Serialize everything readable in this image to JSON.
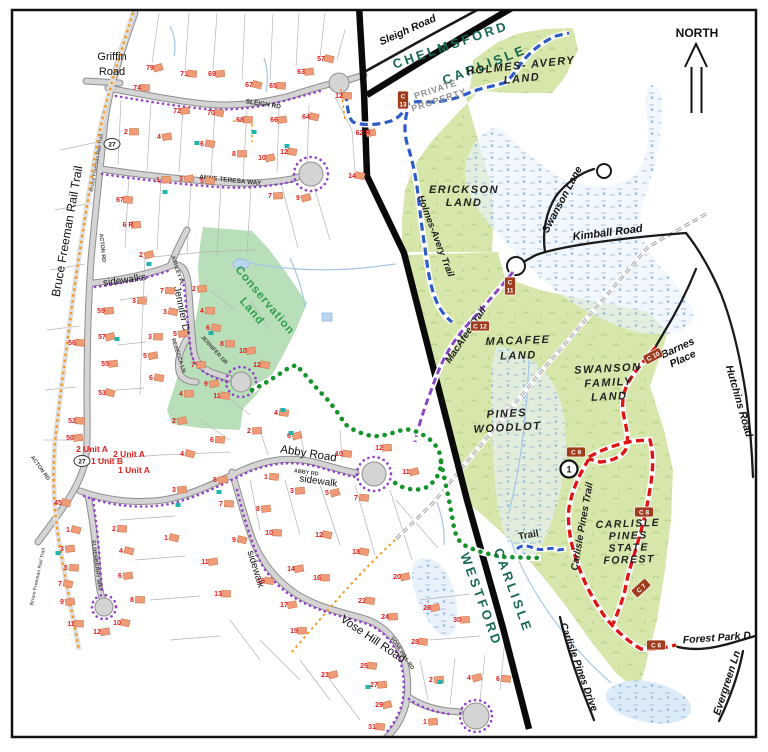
{
  "map": {
    "north_label": "NORTH",
    "towns": {
      "chelmsford": "CHELMSFORD",
      "carlisle_top": "CARLISLE",
      "westford": "WESTFORD",
      "carlisle_bottom": "CARLISLE"
    },
    "lands": {
      "holmes_avery": [
        "HOLMES- AVERY",
        "LAND"
      ],
      "erickson": [
        "ERICKSON",
        "LAND"
      ],
      "macafee": [
        "MACAFEE",
        "LAND"
      ],
      "swanson_family": [
        "SWANSON",
        "FAMILY",
        "LAND"
      ],
      "pines_woodlot": [
        "PINES",
        "WOODLOT"
      ],
      "carlisle_pines_forest": [
        "CARLISLE",
        "PINES",
        "STATE",
        "FOREST"
      ],
      "conservation": [
        "Conservation",
        "Land"
      ]
    },
    "trails": {
      "holmes_avery_trail": {
        "label": "Holmes-Avery Trail",
        "color": "#2d5bc8"
      },
      "macafee_trail": {
        "label": "MacAfee Trail",
        "color": "#8a49c0"
      },
      "carlisle_pines_trail": {
        "label": "Carlisle Pines Trail",
        "color": "#e01414"
      },
      "trail": {
        "label": "Trail",
        "color": "#2d5bc8"
      },
      "connector_dots_color": "#14932b",
      "sidewalk_dots_color": "#9440cc",
      "rail_trail_color": "#f5991e"
    },
    "roads": {
      "griffin": [
        "Griffin",
        "Road"
      ],
      "sleigh_small": "SLEIGH RD",
      "sleigh_road": "Sleigh Road",
      "acton": "ACTON RD",
      "anne_teresa": "ANNE TERESA WAY",
      "ashley": "ASHLEY PL",
      "jennifer": "Jennifer Dr",
      "jennifer_small": "JENNIFER DR",
      "rebecca": "REBECCA LN",
      "abby": "Abby Road",
      "abby_small": "ABBY RD",
      "vose": "Vose Hill Road",
      "vose_small": "VOSE HILL RD",
      "elderberry": "ELDERBERRY WAY",
      "bruce_freeman": "Bruce Freeman Rail Trail",
      "bruce_freeman_small": "Bruce Freeman Rail Trail",
      "swanson_lane": "Swanson Lane",
      "kimball": "Kimball Road",
      "hutchins": "Hutchins Road",
      "barnes": [
        "Barnes",
        "Place"
      ],
      "forest_park": "Forest Park D",
      "evergreen": "Evergreen Ln",
      "carlisle_pines_drive": "Carlisle Pines Drive"
    },
    "labels": {
      "private_property": [
        "PRIVATE",
        "PROPERTY"
      ],
      "sidewalks": "sidewalks",
      "sidewalk": "sidewalk",
      "route_shield": "27"
    },
    "unit_labels": [
      {
        "text": "2 Unit A",
        "x": 92,
        "y": 452
      },
      {
        "text": "2 Unit A",
        "x": 129,
        "y": 457
      },
      {
        "text": "1 Unit B",
        "x": 107,
        "y": 464
      },
      {
        "text": "1 Unit A",
        "x": 134,
        "y": 473
      }
    ],
    "markers": [
      {
        "id": "C13",
        "c": "C",
        "n": "13",
        "x": 403,
        "y": 100,
        "vert": true,
        "rot": 0
      },
      {
        "id": "C11",
        "c": "C",
        "n": "11",
        "x": 510,
        "y": 286,
        "vert": true,
        "rot": 0
      },
      {
        "id": "C12",
        "c": "C",
        "n": "12",
        "x": 480,
        "y": 326,
        "vert": false,
        "rot": 0
      },
      {
        "id": "C10",
        "c": "C",
        "n": "10",
        "x": 653,
        "y": 356,
        "vert": false,
        "rot": -28
      },
      {
        "id": "C9",
        "c": "C",
        "n": "9",
        "x": 576,
        "y": 452,
        "vert": false,
        "rot": 0
      },
      {
        "id": "C8",
        "c": "C",
        "n": "8",
        "x": 644,
        "y": 512,
        "vert": false,
        "rot": 0
      },
      {
        "id": "C7",
        "c": "C",
        "n": "7",
        "x": 641,
        "y": 588,
        "vert": false,
        "rot": -42
      },
      {
        "id": "C6",
        "c": "C",
        "n": "6",
        "x": 656,
        "y": 645,
        "vert": false,
        "rot": 0
      }
    ],
    "junction": {
      "label": "1",
      "x": 569,
      "y": 469
    },
    "shields": [
      {
        "x": 112,
        "y": 144
      },
      {
        "x": 82,
        "y": 461
      }
    ],
    "houses": [
      {
        "n": "79",
        "x": 150,
        "y": 70
      },
      {
        "n": "71",
        "x": 184,
        "y": 76
      },
      {
        "n": "69",
        "x": 212,
        "y": 76
      },
      {
        "n": "67",
        "x": 249,
        "y": 87
      },
      {
        "n": "65",
        "x": 273,
        "y": 88
      },
      {
        "n": "63",
        "x": 301,
        "y": 74
      },
      {
        "n": "57",
        "x": 321,
        "y": 61
      },
      {
        "n": "74",
        "x": 137,
        "y": 90
      },
      {
        "n": "72",
        "x": 177,
        "y": 113
      },
      {
        "n": "70",
        "x": 211,
        "y": 115
      },
      {
        "n": "68",
        "x": 240,
        "y": 122
      },
      {
        "n": "66",
        "x": 274,
        "y": 122
      },
      {
        "n": "64",
        "x": 306,
        "y": 119
      },
      {
        "n": "12",
        "x": 339,
        "y": 98
      },
      {
        "n": "62 R",
        "x": 363,
        "y": 135
      },
      {
        "n": "14",
        "x": 352,
        "y": 178
      },
      {
        "n": "2",
        "x": 126,
        "y": 134
      },
      {
        "n": "4",
        "x": 159,
        "y": 139
      },
      {
        "n": "6",
        "x": 202,
        "y": 146
      },
      {
        "n": "8",
        "x": 234,
        "y": 156
      },
      {
        "n": "10",
        "x": 262,
        "y": 160
      },
      {
        "n": "12",
        "x": 284,
        "y": 154
      },
      {
        "n": "1",
        "x": 158,
        "y": 182
      },
      {
        "n": "3",
        "x": 181,
        "y": 181
      },
      {
        "n": "5",
        "x": 202,
        "y": 183
      },
      {
        "n": "7",
        "x": 270,
        "y": 198
      },
      {
        "n": "9",
        "x": 298,
        "y": 200
      },
      {
        "n": "67",
        "x": 120,
        "y": 202
      },
      {
        "n": "6 R",
        "x": 128,
        "y": 227
      },
      {
        "n": "2",
        "x": 141,
        "y": 257
      },
      {
        "n": "3",
        "x": 134,
        "y": 303
      },
      {
        "n": "59",
        "x": 101,
        "y": 313
      },
      {
        "n": "57",
        "x": 102,
        "y": 339
      },
      {
        "n": "56",
        "x": 72,
        "y": 345
      },
      {
        "n": "55",
        "x": 105,
        "y": 366
      },
      {
        "n": "53",
        "x": 102,
        "y": 395
      },
      {
        "n": "52",
        "x": 72,
        "y": 423
      },
      {
        "n": "50",
        "x": 70,
        "y": 440
      },
      {
        "n": "45",
        "x": 58,
        "y": 505
      },
      {
        "n": "7",
        "x": 162,
        "y": 293
      },
      {
        "n": "2",
        "x": 194,
        "y": 291
      },
      {
        "n": "3",
        "x": 165,
        "y": 314
      },
      {
        "n": "4",
        "x": 202,
        "y": 313
      },
      {
        "n": "5",
        "x": 175,
        "y": 336
      },
      {
        "n": "6",
        "x": 208,
        "y": 330
      },
      {
        "n": "3",
        "x": 150,
        "y": 339
      },
      {
        "n": "5",
        "x": 145,
        "y": 358
      },
      {
        "n": "6",
        "x": 151,
        "y": 380
      },
      {
        "n": "8",
        "x": 222,
        "y": 346
      },
      {
        "n": "10",
        "x": 243,
        "y": 353
      },
      {
        "n": "12",
        "x": 257,
        "y": 367
      },
      {
        "n": "7",
        "x": 193,
        "y": 367
      },
      {
        "n": "9",
        "x": 206,
        "y": 386
      },
      {
        "n": "11",
        "x": 217,
        "y": 398
      },
      {
        "n": "4",
        "x": 181,
        "y": 396
      },
      {
        "n": "2",
        "x": 174,
        "y": 423
      },
      {
        "n": "4",
        "x": 276,
        "y": 415
      },
      {
        "n": "2",
        "x": 249,
        "y": 433
      },
      {
        "n": "6",
        "x": 289,
        "y": 438
      },
      {
        "n": "10",
        "x": 339,
        "y": 456
      },
      {
        "n": "12",
        "x": 379,
        "y": 450
      },
      {
        "n": "11",
        "x": 406,
        "y": 474
      },
      {
        "n": "1",
        "x": 266,
        "y": 479
      },
      {
        "n": "3",
        "x": 292,
        "y": 493
      },
      {
        "n": "5",
        "x": 327,
        "y": 495
      },
      {
        "n": "7",
        "x": 356,
        "y": 500
      },
      {
        "n": "5",
        "x": 215,
        "y": 482
      },
      {
        "n": "4",
        "x": 182,
        "y": 456
      },
      {
        "n": "6",
        "x": 212,
        "y": 442
      },
      {
        "n": "3",
        "x": 174,
        "y": 492
      },
      {
        "n": "1",
        "x": 166,
        "y": 540
      },
      {
        "n": "7",
        "x": 221,
        "y": 506
      },
      {
        "n": "8",
        "x": 258,
        "y": 511
      },
      {
        "n": "9",
        "x": 234,
        "y": 542
      },
      {
        "n": "10",
        "x": 269,
        "y": 535
      },
      {
        "n": "11",
        "x": 205,
        "y": 564
      },
      {
        "n": "12",
        "x": 319,
        "y": 537
      },
      {
        "n": "13",
        "x": 218,
        "y": 596
      },
      {
        "n": "14",
        "x": 291,
        "y": 571
      },
      {
        "n": "15",
        "x": 261,
        "y": 583
      },
      {
        "n": "16",
        "x": 317,
        "y": 580
      },
      {
        "n": "17",
        "x": 284,
        "y": 607
      },
      {
        "n": "18",
        "x": 356,
        "y": 554
      },
      {
        "n": "19",
        "x": 294,
        "y": 633
      },
      {
        "n": "20",
        "x": 397,
        "y": 579
      },
      {
        "n": "22",
        "x": 362,
        "y": 603
      },
      {
        "n": "24",
        "x": 385,
        "y": 619
      },
      {
        "n": "26",
        "x": 427,
        "y": 610
      },
      {
        "n": "28",
        "x": 415,
        "y": 644
      },
      {
        "n": "30",
        "x": 457,
        "y": 622
      },
      {
        "n": "21",
        "x": 325,
        "y": 677
      },
      {
        "n": "25",
        "x": 364,
        "y": 668
      },
      {
        "n": "27",
        "x": 374,
        "y": 687
      },
      {
        "n": "29",
        "x": 379,
        "y": 707
      },
      {
        "n": "31",
        "x": 372,
        "y": 729
      },
      {
        "n": "2",
        "x": 431,
        "y": 682
      },
      {
        "n": "4",
        "x": 469,
        "y": 680
      },
      {
        "n": "6",
        "x": 498,
        "y": 681
      },
      {
        "n": "1",
        "x": 425,
        "y": 724
      },
      {
        "n": "1",
        "x": 68,
        "y": 532
      },
      {
        "n": "2",
        "x": 114,
        "y": 531
      },
      {
        "n": "3",
        "x": 62,
        "y": 551
      },
      {
        "n": "4",
        "x": 121,
        "y": 553
      },
      {
        "n": "5",
        "x": 66,
        "y": 570
      },
      {
        "n": "6",
        "x": 120,
        "y": 578
      },
      {
        "n": "7",
        "x": 60,
        "y": 586
      },
      {
        "n": "8",
        "x": 132,
        "y": 602
      },
      {
        "n": "9",
        "x": 62,
        "y": 604
      },
      {
        "n": "10",
        "x": 117,
        "y": 625
      },
      {
        "n": "11",
        "x": 71,
        "y": 626
      },
      {
        "n": "12",
        "x": 97,
        "y": 634
      }
    ],
    "pools": [
      [
        197,
        143
      ],
      [
        254,
        132
      ],
      [
        287,
        146
      ],
      [
        165,
        192
      ],
      [
        149,
        264
      ],
      [
        211,
        333
      ],
      [
        117,
        339
      ],
      [
        283,
        410
      ],
      [
        291,
        433
      ],
      [
        219,
        492
      ],
      [
        178,
        505
      ],
      [
        440,
        682
      ],
      [
        368,
        687
      ],
      [
        58,
        553
      ]
    ],
    "colors": {
      "conservation_green": "#b9dfba",
      "forest_green": "#d7e7ab",
      "town_label": "#17694f",
      "marker_bg": "#a03c1c",
      "house_fill": "#ef9b77",
      "house_number": "#e21d1d",
      "boundary": "#0a0a0a",
      "wetland": "#e9f2fb"
    }
  }
}
